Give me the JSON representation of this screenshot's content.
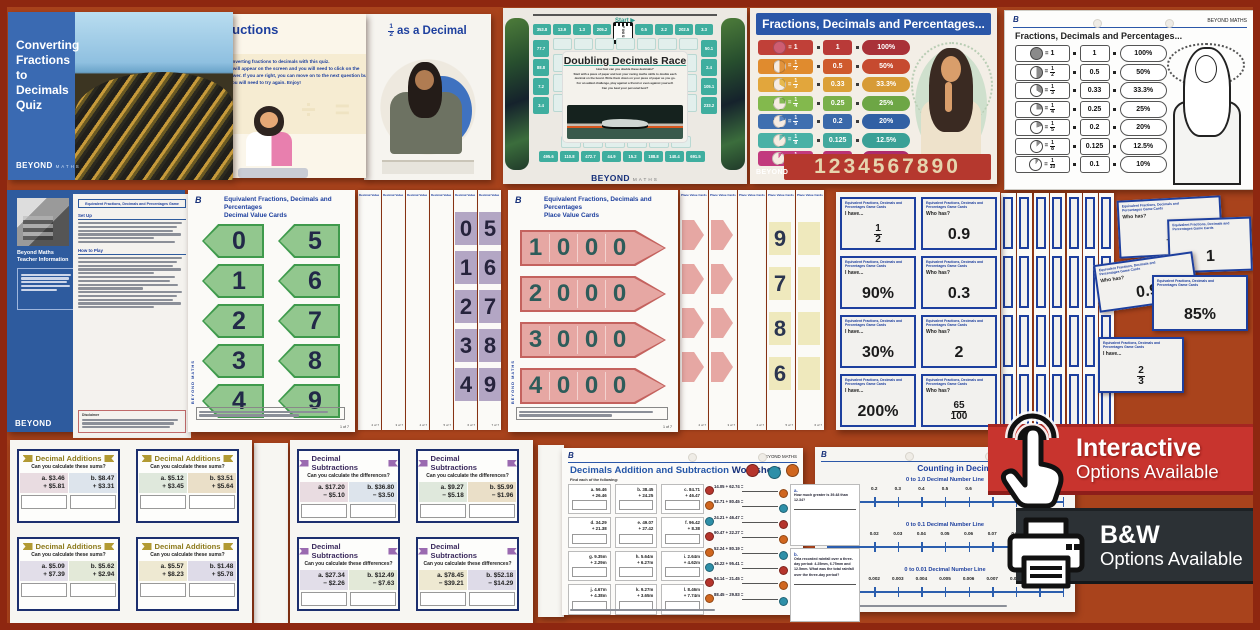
{
  "brand": {
    "beyond": "BEYOND",
    "maths": "MATHS",
    "b": "B",
    "beyond_maths": "BEYOND MATHS"
  },
  "quiz_deck": {
    "slide1": {
      "title": "Converting Fractions to Decimals Quiz"
    },
    "slide2": {
      "title": "Instructions",
      "body_lines": [
        "Practise converting fractions to decimals with this quiz.",
        "A question will appear on the screen and you will need to click on the",
        "correct answer. If you are right, you can move on to the next question but if it",
        "is wrong, you will need to try again. Enjoy!"
      ],
      "watermark": "÷  ="
    },
    "slide3": {
      "frac_num": "1",
      "frac_den": "2",
      "title_rest": "as a Decimal"
    }
  },
  "race_board": {
    "start_label": "Start ▶",
    "finish_label": "FINISH",
    "title": "Doubling Decimals Race",
    "intro_lines": [
      "How fast can you double these decimals?",
      "Start with a piece of paper and test your racing maths skills to double each decimal on the board. Write them down on your piece of paper as you go.",
      "For an added challenge, play against a friend or even against yourself.",
      "Can you beat your personal best?"
    ],
    "top_cells": [
      "353.8",
      "13.9",
      "1.3",
      "205.2",
      "FINISH",
      "0.5",
      "2.2",
      "202.5",
      "3.3"
    ],
    "left_cells": [
      "77.7",
      "88.8",
      "7.2",
      "3.4"
    ],
    "right_cells": [
      "50.1",
      "2.4",
      "105.1",
      "233.2"
    ],
    "bottom_cells": [
      "495.6",
      "110.8",
      "472.7",
      "44.9",
      "15.2",
      "188.8",
      "140.4",
      "691.5"
    ]
  },
  "fdp": {
    "title": "Fractions, Decimals and Percentages...",
    "digits": "1234567890",
    "rows": [
      {
        "num": "1",
        "den": null,
        "decimal": "1",
        "percent": "100%",
        "frac_bg": "#c04038",
        "dec_bg": "#b93a38",
        "pct_bg": "#a93138",
        "pie_color": "#ce5d72",
        "pie_frac": 1
      },
      {
        "num": "1",
        "den": "2",
        "decimal": "0.5",
        "percent": "50%",
        "frac_bg": "#e08b2e",
        "dec_bg": "#cf5a2d",
        "pct_bg": "#c64a2f",
        "pie_color": "#e2933c",
        "pie_frac": 0.5
      },
      {
        "num": "1",
        "den": "3",
        "decimal": "0.33",
        "percent": "33.3%",
        "frac_bg": "#e2a63c",
        "dec_bg": "#dba038",
        "pct_bg": "#d79b36",
        "pie_color": "#e6b94f",
        "pie_frac": 0.333
      },
      {
        "num": "1",
        "den": "4",
        "decimal": "0.25",
        "percent": "25%",
        "frac_bg": "#83b94d",
        "dec_bg": "#7ab04a",
        "pct_bg": "#6da645",
        "pie_color": "#86b957",
        "pie_frac": 0.25
      },
      {
        "num": "1",
        "den": "5",
        "decimal": "0.2",
        "percent": "20%",
        "frac_bg": "#3f6fb0",
        "dec_bg": "#3a69aa",
        "pct_bg": "#3160a4",
        "pie_color": "#5b88c4",
        "pie_frac": 0.2
      },
      {
        "num": "1",
        "den": "8",
        "decimal": "0.125",
        "percent": "12.5%",
        "frac_bg": "#49b1a6",
        "dec_bg": "#42a89d",
        "pct_bg": "#3aa096",
        "pie_color": "#66c1b6",
        "pie_frac": 0.125
      },
      {
        "num": "1",
        "den": "10",
        "decimal": "0.1",
        "percent": "10%",
        "frac_bg": "#c23a7e",
        "dec_bg": "#b93376",
        "pct_bg": "#ad2c6e",
        "pie_color": "#d45f97",
        "pie_frac": 0.1
      }
    ]
  },
  "teacher_info": {
    "sidebar_title": "Beyond Maths Teacher Information",
    "page_title": "Equivalent Fractions, Decimals and Percentages Game",
    "heading1": "Set Up",
    "heading2": "How to Play",
    "disclaimer_heading": "Disclaimer"
  },
  "decimal_value_cards": {
    "title1": "Equivalent Fractions, Decimals and Percentages",
    "title2": "Decimal Value Cards",
    "left_digits": [
      "0",
      "1",
      "2",
      "3",
      "4"
    ],
    "right_digits": [
      "5",
      "6",
      "7",
      "8",
      "9"
    ],
    "page": "1 of 7",
    "back_pages": [
      "2 of 7",
      "3 of 7",
      "4 of 7",
      "5 of 7",
      "6 of 7",
      "7 of 7"
    ],
    "strip_header": "Decimal Value Cards"
  },
  "place_value_cards": {
    "title1": "Equivalent Fractions, Decimals and Percentages",
    "title2": "Place Value Cards",
    "rows": [
      [
        "1",
        "0",
        "0",
        "0"
      ],
      [
        "2",
        "0",
        "0",
        "0"
      ],
      [
        "3",
        "0",
        "0",
        "0"
      ],
      [
        "4",
        "0",
        "0",
        "0"
      ]
    ],
    "back_digits": [
      "9",
      "7",
      "8",
      "6"
    ],
    "page": "1 of 7",
    "back_pages": [
      "2 of 7",
      "3 of 7",
      "4 of 7",
      "5 of 7",
      "6 of 7"
    ],
    "strip_header": "Place Value Cards"
  },
  "game_cards": {
    "header1": "Equivalent Fractions, Decimals and",
    "header2": "Percentages Game Cards",
    "i_have": "I have...",
    "who_has": "Who has?",
    "grid": [
      {
        "label": "i_have",
        "type": "frac",
        "num": "1",
        "den": "2"
      },
      {
        "label": "who_has",
        "type": "text",
        "value": "0.9"
      },
      {
        "label": "i_have",
        "type": "text",
        "value": "90%"
      },
      {
        "label": "who_has",
        "type": "text",
        "value": "0.3"
      },
      {
        "label": "i_have",
        "type": "text",
        "value": "30%"
      },
      {
        "label": "who_has",
        "type": "text",
        "value": "2"
      },
      {
        "label": "i_have",
        "type": "text",
        "value": "200%"
      },
      {
        "label": "who_has",
        "type": "frac",
        "num": "65",
        "den": "100"
      }
    ],
    "scattered": [
      {
        "label": "who_has",
        "type": "frac",
        "num": "5",
        "den": "6"
      },
      {
        "label": "",
        "type": "text",
        "value": "1"
      },
      {
        "label": "who_has",
        "type": "text",
        "value": "0.9"
      },
      {
        "label": "",
        "type": "text",
        "value": "85%"
      },
      {
        "label": "i_have",
        "type": "frac",
        "num": "2",
        "den": "3"
      }
    ]
  },
  "addition_cards": {
    "banner": "Decimal Additions",
    "prompts": [
      "Can you calculate these sums?",
      "Can you calculate these sums?",
      "Can you calculate these sums?",
      "Can you calculate these sums?"
    ],
    "cards": [
      {
        "a1": "a.  $3.46",
        "a2": "+ $5.81",
        "b1": "b.  $8.47",
        "b2": "+ $3.31"
      },
      {
        "a1": "a.  $5.12",
        "a2": "+ $3.45",
        "b1": "b.  $3.51",
        "b2": "+ $5.64"
      },
      {
        "a1": "a.  $5.09",
        "a2": "+ $7.39",
        "b1": "b.  $5.62",
        "b2": "+ $2.94"
      },
      {
        "a1": "a.  $5.57",
        "a2": "+ $8.23",
        "b1": "b.  $1.48",
        "b2": "+ $5.78"
      }
    ]
  },
  "subtraction_cards": {
    "banner": "Decimal Subtractions",
    "prompts": [
      "Can you calculate the differences?",
      "Can you calculate the differences?",
      "Can you calculate these differences?",
      "Can you calculate these differences?"
    ],
    "cards": [
      {
        "a1": "a. $17.20",
        "a2": "− $5.10",
        "b1": "b. $36.80",
        "b2": "− $3.50"
      },
      {
        "a1": "a.  $9.27",
        "a2": "− $5.18",
        "b1": "b.  $5.99",
        "b2": "− $1.96"
      },
      {
        "a1": "a. $27.34",
        "a2": "− $2.26",
        "b1": "b. $12.49",
        "b2": "− $7.63"
      },
      {
        "a1": "a. $78.45",
        "a2": "− $39.21",
        "b1": "b. $52.18",
        "b2": "− $14.29"
      }
    ]
  },
  "worksheet": {
    "title_main": "Decimals Addition and Subtraction ",
    "title_bold": "Worksheet",
    "subtitle": "Find each of the following:",
    "grid": [
      {
        "t": "a.  56.46",
        "b": "+ 26.46"
      },
      {
        "t": "b.  38.45",
        "b": "+ 24.25"
      },
      {
        "t": "c.  84.71",
        "b": "+ 46.47"
      },
      {
        "t": "d.  34.29",
        "b": "+ 21.38"
      },
      {
        "t": "e.  49.07",
        "b": "+ 27.42"
      },
      {
        "t": "f.  96.42",
        "b": "+  8.38"
      },
      {
        "t": "g.  9.35m",
        "b": "+ 2.29m"
      },
      {
        "t": "h.  5.64m",
        "b": "+ 6.27m"
      },
      {
        "t": "i.  2.64m",
        "b": "+ 4.62m"
      },
      {
        "t": "j.  4.67m",
        "b": "+ 4.38m"
      },
      {
        "t": "k.  9.27m",
        "b": "+ 3.65m"
      },
      {
        "t": "l.  8.46m",
        "b": "+ 7.74m"
      }
    ],
    "equations": [
      "14.05 + 62.74 =",
      "92.71 + 80.45 =",
      "24.21 + 46.47 =",
      "90.47 + 22.27 =",
      "52.24 + 80.19 =",
      "46.22 + 95.41 =",
      "94.14 − 21.45 =",
      "88.45 − 29.83 ="
    ],
    "problems": [
      {
        "label": "a.",
        "text": "How much greater is 39.48 than 12.34?"
      },
      {
        "label": "b.",
        "text": "Orla recorded rainfall over a three-day period: 4.25mm, 6.75mm and 12.5mm. What was the total rainfall over the three-day period?"
      }
    ]
  },
  "number_lines": {
    "title": "Counting in Decimals Number Lines",
    "lines": [
      {
        "subtitle": "0 to 1.0 Decimal Number Line",
        "labels": [
          "0",
          "0.1",
          "0.2",
          "0.3",
          "0.4",
          "0.5",
          "0.6",
          "0.7",
          "0.8",
          "0.9",
          "1.0"
        ]
      },
      {
        "subtitle": "0 to 0.1 Decimal Number Line",
        "labels": [
          "0",
          "0.01",
          "0.02",
          "0.03",
          "0.04",
          "0.05",
          "0.06",
          "0.07",
          "0.08",
          "0.09",
          "0.1"
        ]
      },
      {
        "subtitle": "0 to 0.01 Decimal Number Line",
        "labels": [
          "0",
          "0.001",
          "0.002",
          "0.003",
          "0.004",
          "0.005",
          "0.006",
          "0.007",
          "0.008",
          "0.009",
          "0.01"
        ]
      }
    ]
  },
  "banners": {
    "interactive": {
      "line1": "Interactive",
      "line2": "Options Available"
    },
    "bw": {
      "line1": "B&W",
      "line2": "Options Available"
    }
  }
}
